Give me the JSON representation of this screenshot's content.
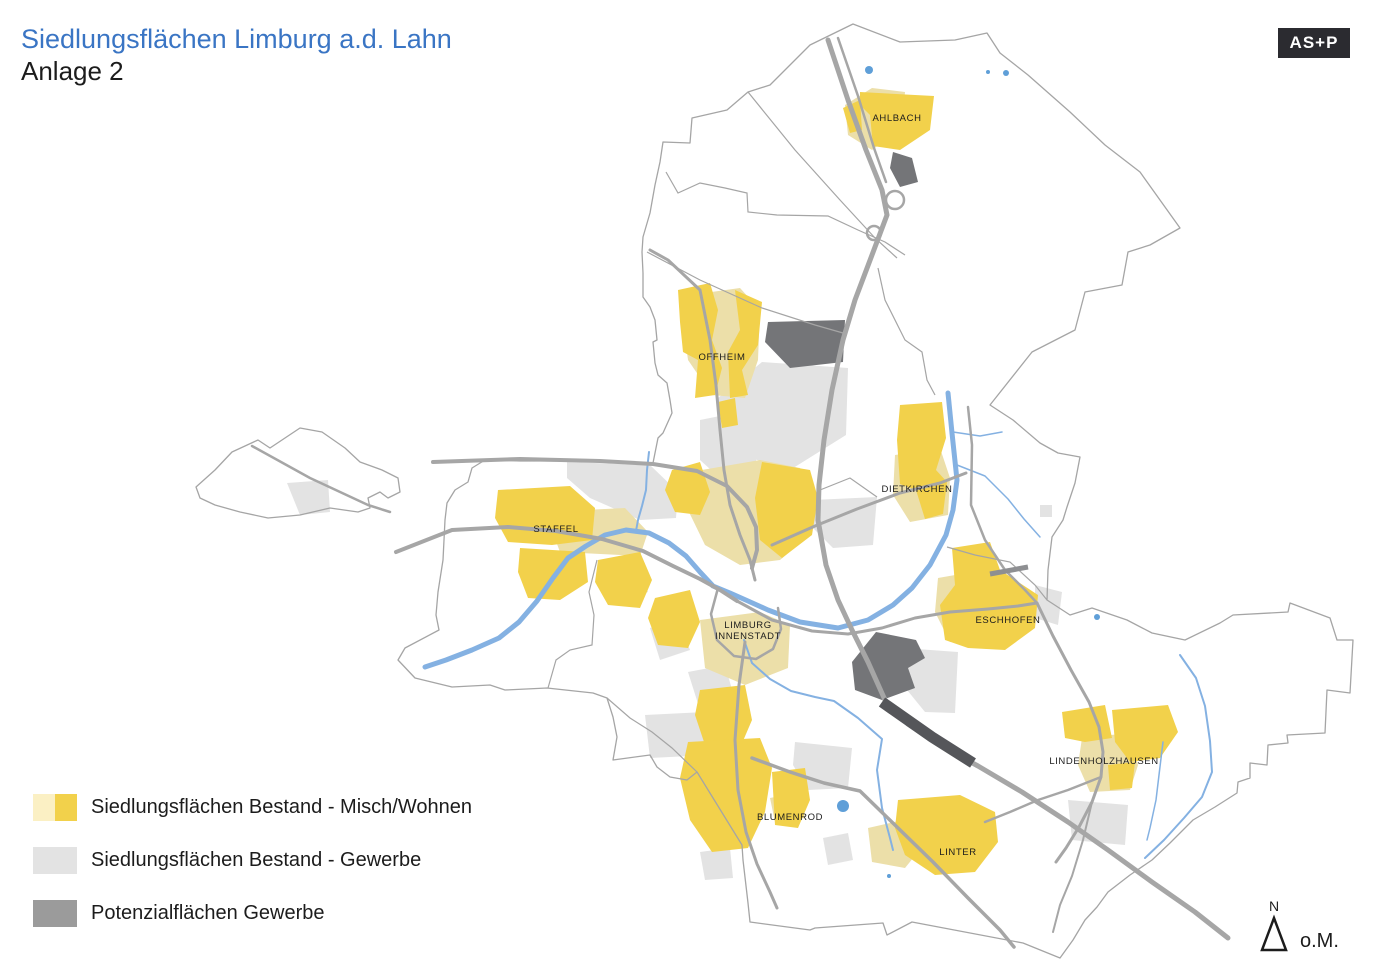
{
  "header": {
    "title": "Siedlungsflächen Limburg a.d. Lahn",
    "subtitle": "Anlage 2",
    "logo_text": "AS+P"
  },
  "legend": {
    "items": [
      {
        "label": "Siedlungsflächen Bestand - Misch/Wohnen",
        "swatch": [
          "#fbf0c4",
          "#f2d14b"
        ]
      },
      {
        "label": "Siedlungsflächen Bestand - Gewerbe",
        "swatch": [
          "#e3e3e3",
          "#e3e3e3"
        ]
      },
      {
        "label": "Potenzialflächen Gewerbe",
        "swatch": [
          "#9b9b9b",
          "#9b9b9b"
        ]
      }
    ]
  },
  "north_arrow": {
    "label": "N",
    "scale_note": "o.M."
  },
  "map": {
    "colors": {
      "beige": "#ecdfa9",
      "yellow": "#f2d14b",
      "gray": "#e3e3e3",
      "dark": "#747578",
      "rail": "#55565a",
      "rail_light": "#8e8f92",
      "road": "#a6a6a6",
      "boundary": "#a5a5a5",
      "river": "#84b1e2",
      "pond": "#5f9fd8",
      "label": "#1c1c1c"
    },
    "labels": [
      {
        "text": "AHLBACH",
        "x": 897,
        "y": 121
      },
      {
        "text": "OFFHEIM",
        "x": 722,
        "y": 360
      },
      {
        "text": "DIETKIRCHEN",
        "x": 917,
        "y": 492
      },
      {
        "text": "STAFFEL",
        "x": 556,
        "y": 532
      },
      {
        "text": "LIMBURG\nINNENSTADT",
        "x": 748,
        "y": 628
      },
      {
        "text": "ESCHHOFEN",
        "x": 1008,
        "y": 623
      },
      {
        "text": "LINDENHOLZHAUSEN",
        "x": 1104,
        "y": 764
      },
      {
        "text": "BLUMENROD",
        "x": 790,
        "y": 820
      },
      {
        "text": "LINTER",
        "x": 958,
        "y": 855
      }
    ],
    "outer_boundary": [
      "853,24 900,42 955,40 987,33 1000,53 1028,75 1070,112 1105,145 1140,172 1180,228 1150,245 1128,252 1122,285 1085,292 1075,330 1032,352 990,405 1013,420 1040,443 1058,453 1080,457 1075,483 1067,507 1063,520 1052,537 1048,570 1047,600 1070,615 1092,608 1127,620 1152,633 1185,640 1220,623 1233,615 1288,612 1290,603 1330,618 1337,640 1353,640 1350,693 1327,690 1325,733 1287,735 1288,743 1268,745 1267,765 1250,763 1250,778 1238,782 1237,793 1215,807 1193,820 1170,843 1152,860 1130,875 1108,892 1097,907 1085,920 1073,940 1060,958 1023,943 912,922 887,935 883,923 815,928 810,930 750,922 748,903 743,860 742,845 697,772 687,780 670,777 657,767 650,755 613,760 617,737 613,717 607,698 593,693 547,688 505,690 490,685 452,687 415,678 398,660 405,648 439,630 436,615 438,592 443,560 445,520 447,503 455,490 468,482 472,468 485,460 520,461 600,461 653,463 658,438 663,433 672,413 670,400 667,383 658,375 655,363 653,342 657,340 655,320 650,307 643,297 643,273 642,252 643,237 650,213 655,185 660,162 663,142 690,143 692,118 727,110 748,92 770,85 810,45",
      "196,487 215,470 232,452 258,440 270,448 282,440 300,428 322,432 345,448 360,462 382,470 398,478 400,492 388,498 380,492 368,498 370,508 358,512 330,508 300,515 268,518 240,512 215,505 200,498"
    ],
    "internal_boundaries": [
      "666,172 678,193 700,183 725,188 747,193 748,212 777,215 828,216 858,230 885,242 905,255",
      "748,92 795,150 840,200 875,238 897,258",
      "647,252 700,280 762,308 815,325 843,333",
      "597,560 589,592 594,615 592,645 570,650 556,660 548,688",
      "878,268 885,300 905,340 922,352 927,380 935,395",
      "947,547 975,555 1010,562 1035,585 1047,600",
      "607,698 630,718 652,732 672,748 697,772",
      "820,490 850,478 877,497"
    ],
    "areas": {
      "gray": [
        "762,362 848,368 846,435 790,470 718,448 718,398",
        "700,420 740,412 758,440 755,472 720,478 700,460",
        "813,500 877,497 873,545 833,548 813,528",
        "903,648 958,652 955,713 925,712 903,685",
        "567,462 650,465 678,492 676,518 640,520 590,498 567,478",
        "612,575 640,568 648,592 620,600",
        "650,628 678,620 690,650 660,660",
        "688,672 725,665 735,700 700,710",
        "645,715 705,712 710,755 650,758",
        "795,742 852,748 848,788 808,790 793,765",
        "700,852 730,848 733,878 705,880",
        "1068,800 1128,805 1125,845 1072,840",
        "287,483 328,480 330,512 300,515",
        "1040,505 1052,505 1052,517 1040,517",
        "823,838 848,833 853,860 828,865",
        "1035,585 1062,592 1058,625 1035,618",
        "755,525 790,518 798,545 762,552"
      ],
      "beige": [
        "845,105 872,88 905,92 902,128 872,150 848,135",
        "690,295 740,288 760,310 758,360 745,398 712,395 688,360 683,322",
        "895,455 940,448 950,478 948,515 910,522 893,495",
        "545,512 625,508 648,532 640,556 560,552",
        "690,472 760,460 800,468 815,495 810,535 780,560 740,565 705,545 688,510",
        "700,620 760,612 790,625 788,668 745,685 705,668",
        "938,578 995,568 1002,598 995,638 950,642 935,612",
        "1082,738 1130,733 1138,765 1130,790 1090,792 1078,765",
        "868,828 912,818 918,852 905,868 872,862",
        "770,798 800,792 805,818 775,822"
      ],
      "yellow": [
        "860,92 934,96 930,130 900,150 873,146 870,115 860,105",
        "843,108 860,100 862,130 850,133",
        "678,290 710,283 718,310 712,340 722,368 715,395 695,398 698,360 683,352 680,322",
        "735,290 762,302 758,345 742,370 748,395 730,398 728,352 740,330",
        "718,402 735,398 738,425 722,428",
        "900,405 942,402 946,438 936,470 947,482 943,514 925,519 916,490 900,484 897,440",
        "498,490 570,486 595,508 592,540 552,545 508,542 495,518",
        "520,548 585,552 588,582 560,600 528,598 518,572",
        "762,462 810,470 818,498 812,535 782,558 760,540 755,498",
        "598,560 640,552 652,580 640,608 608,605 595,582",
        "655,598 690,590 700,622 688,648 658,645 648,618",
        "672,470 700,462 710,492 700,515 675,512 665,490",
        "700,690 745,685 752,720 740,748 705,745 695,715",
        "688,742 760,738 772,768 765,812 748,848 712,852 690,820 680,778",
        "772,772 805,768 810,800 798,828 775,825",
        "898,800 960,795 995,812 998,842 975,872 935,875 905,855 895,828",
        "952,548 990,542 1000,570 1038,595 1035,628 1005,650 968,648 945,640 940,605 955,585",
        "1062,712 1105,705 1112,738 1085,742 1065,738",
        "1112,710 1168,705 1178,732 1160,758 1130,762 1115,742",
        "1108,765 1135,762 1132,788 1110,790"
      ],
      "dark": [
        "893,152 912,158 918,182 900,187 890,168",
        "768,322 845,320 843,362 790,368 765,342",
        "852,662 876,632 916,640 925,658 908,668 915,688 882,700 855,690"
      ]
    },
    "rivers": [
      {
        "pts": "948,393 952,433 957,480 953,510 946,535 930,565 912,588 893,605 868,620 838,628 800,622 768,610 748,601 730,593 713,586 700,572 686,556 669,543 649,533 626,530 605,535 586,546 568,558 553,578 537,601 519,622 499,638 472,650 446,660 425,667",
        "w": 5
      },
      {
        "pts": "649,452 647,470 646,490 642,506 638,520 636,531",
        "w": 2
      },
      {
        "pts": "744,640 752,663 770,679 791,691 815,697 834,701 858,718 882,739 877,770 882,808 890,838 893,850",
        "w": 2
      },
      {
        "pts": "957,465 985,476 1008,499 1024,519 1040,537",
        "w": 1.5
      },
      {
        "pts": "953,432 980,436 1002,432",
        "w": 1.5
      },
      {
        "pts": "1180,655 1196,678 1205,706 1210,741 1212,772 1202,797 1184,818 1164,840 1145,858",
        "w": 2
      },
      {
        "pts": "1163,742 1159,775 1156,800 1150,828 1147,840",
        "w": 1.5
      }
    ],
    "roads": [
      {
        "pts": "828,40 848,100 866,150 882,190 887,215 872,255 855,300 843,340 832,390 824,440 819,485 818,520 826,565 838,600 852,630 868,662 885,700 908,724 938,744 978,766 1022,792 1068,822 1108,850 1152,882 1195,912 1228,938",
        "w": 5
      },
      {
        "pts": "838,38 858,96 874,148 886,182",
        "w": 2.5
      },
      {
        "pts": "396,552 452,530 508,527 556,531 602,539 643,551 673,566 700,579 720,590 737,601",
        "w": 4
      },
      {
        "pts": "737,601 772,620 812,631 848,634 882,628 915,618 950,612 988,609 1018,606 1037,603",
        "w": 3
      },
      {
        "pts": "433,462 520,459 600,461 653,464 697,471 727,486 747,507 756,527 757,550 752,568",
        "w": 4
      },
      {
        "pts": "650,250 668,260 700,290 710,340 716,385 720,430 724,470 730,505 740,535 750,560 755,580",
        "w": 3
      },
      {
        "pts": "772,545 815,526 857,509 900,493 940,483 966,473",
        "w": 3
      },
      {
        "pts": "968,407 972,445 971,505 985,540 1005,570 1025,590 1037,603",
        "w": 2.5
      },
      {
        "pts": "1037,603 1053,636 1071,670 1089,702 1099,727 1103,752 1101,777 1092,802 1079,827 1066,848 1056,862",
        "w": 3
      },
      {
        "pts": "1101,777 1068,790 1038,800 1010,812 985,822",
        "w": 2.5
      },
      {
        "pts": "752,758 790,772 824,783 860,791 897,827 933,862 968,898 1000,930 1014,947",
        "w": 3.5
      },
      {
        "pts": "745,642 739,685 735,740 738,790 746,832 757,864 770,892 777,908",
        "w": 3
      },
      {
        "pts": "718,588 711,614 717,640 734,656 756,659 773,649 781,629 778,608",
        "w": 2.5
      },
      {
        "pts": "1092,802 1083,840 1072,876 1060,905 1053,932",
        "w": 2
      },
      {
        "pts": "252,446 310,478 368,505 390,512",
        "w": 2.5
      }
    ],
    "road_loops": [
      {
        "cx": 895,
        "cy": 200,
        "r": 9
      },
      {
        "cx": 874,
        "cy": 233,
        "r": 7
      }
    ],
    "rail": [
      {
        "pts": "882,702 932,737 973,763",
        "w": 11,
        "color_key": "rail"
      },
      {
        "pts": "990,574 1028,567",
        "w": 5,
        "color_key": "rail_light"
      }
    ],
    "ponds": [
      {
        "cx": 869,
        "cy": 70,
        "r": 4
      },
      {
        "cx": 988,
        "cy": 72,
        "r": 2
      },
      {
        "cx": 1006,
        "cy": 73,
        "r": 3
      },
      {
        "cx": 1097,
        "cy": 617,
        "r": 3
      },
      {
        "cx": 843,
        "cy": 806,
        "r": 6
      },
      {
        "cx": 889,
        "cy": 876,
        "r": 2
      }
    ]
  }
}
